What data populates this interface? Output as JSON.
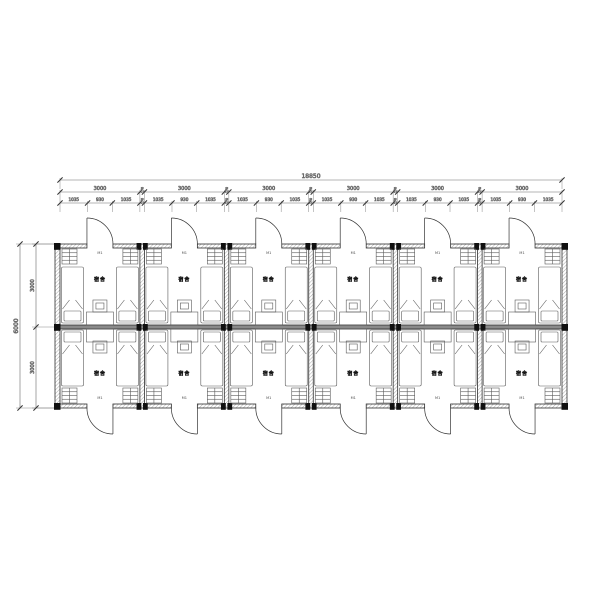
{
  "drawing": {
    "type": "dormitory-floor-plan",
    "bay_count": 6,
    "row_count": 2,
    "room_label": "宿舍",
    "door_mark": "M1"
  },
  "dimensions": {
    "unit": "mm",
    "total_width": "18850",
    "bay_width": "3000",
    "joint_width": "170",
    "bay_subdivisions": [
      "1035",
      "930",
      "1035"
    ],
    "total_depth": "6000",
    "depth_halves": [
      "3000",
      "3000"
    ]
  },
  "colors": {
    "background": "#ffffff",
    "wall_line": "#2e2e2e",
    "wall_hatch": "#a8a8a8",
    "mid_wall_fill": "#8a8a8a",
    "column_fill": "#101010",
    "furniture_line": "#5a5a5a",
    "dim_line": "#6a6a6a",
    "dim_text": "#4d4d4d"
  }
}
